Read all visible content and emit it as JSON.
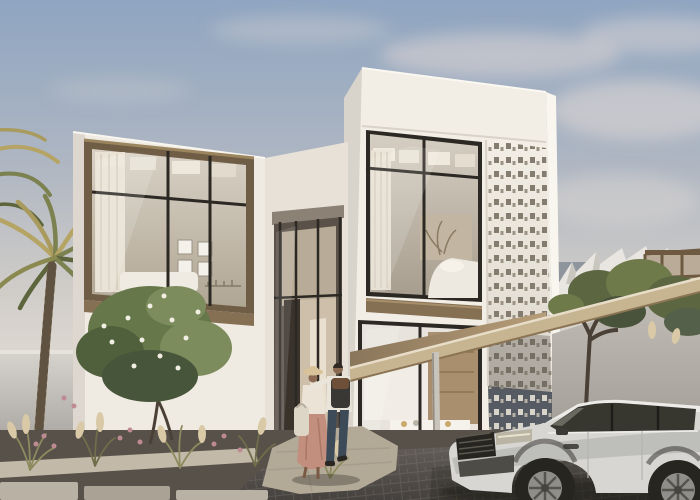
{
  "scene": {
    "alt": "Architectural rendering of a modern two-storey white villa with bronze-framed glazing, a perforated mashrabiya screen, a carport with a white luxury SUV, palm trees, desert garden grasses, and a couple walking toward the entrance",
    "objects": {
      "sky": "hazy blue sky with soft clouds",
      "background": [
        "grey neighbour building",
        "white sawtooth-parapet building",
        "bronze glass pavilion"
      ],
      "villa": [
        "left bedroom block with bronze window box",
        "recessed entrance connector",
        "main two-storey block with bedroom window, kitchen glazing and perforated screen"
      ],
      "carport": "flat canopy with timber soffit and slender post",
      "vehicle": "white luxury SUV, dark glass, parked under carport",
      "people": [
        "woman with straw hat, blush skirt and tote bag",
        "man with backpack, arm around woman"
      ],
      "landscape": [
        "palm trees",
        "flowering shrub",
        "ornamental grasses with pink plumes",
        "stepping-stone path",
        "dark paver driveway"
      ]
    }
  },
  "palette": {
    "sky_top": "#8fa5c1",
    "cloud": "#dcd6d3",
    "wall_sunlit": "#f2eee6",
    "wall_left_block": "#efeae2",
    "wall_connector": "#e7e1d8",
    "wall_side_shade": "#d8d3cb",
    "garden_wall": "#c6c2bb",
    "shade_wall": "#bdb9b1",
    "bronze_frame": "#6f5d45",
    "bronze_band": "#857054",
    "frame_dark": "#2c2823",
    "curtain": "#eae3d6",
    "screen_light": "#f1ece3",
    "screen_dark": "#565b63",
    "soffit_wood": "#a98f6d",
    "fascia_wood": "#c7b592",
    "post": "#c9c4bb",
    "bg_building_gray": "#8e959d",
    "bg_building_white": "#e9e6e1",
    "pavilion_bronze": "#6d5a41",
    "palm_gold": "#b5a464",
    "palm_green": "#7c8150",
    "palm_dark": "#5d653c",
    "trunk": "#7c6a51",
    "bush_green": "#66774a",
    "bush_dark": "#47553a",
    "blossom": "#f1eee4",
    "grass": "#908d5f",
    "plume": "#d9c9a6",
    "flower_pink": "#c08a92",
    "tree_olive": "#5c6742",
    "soil": "#57514a",
    "pavers": "#5e5853",
    "walkway": "#b3a997",
    "stone": "#c2b9a8",
    "car_body": "#d7d6d2",
    "car_glass": "#38372f",
    "car_dark": "#26251f",
    "car_rim": "#8f8e8a",
    "skin": "#8a6a52",
    "hat": "#d8c29a",
    "shirt_man": "#e9e5da",
    "jeans": "#3d4a58",
    "backpack": "#3a3834",
    "backpack_flap": "#6e4f38",
    "skirt": "#c28f7e",
    "tote": "#ddd6c6",
    "hair_dark": "#2f2a24"
  }
}
